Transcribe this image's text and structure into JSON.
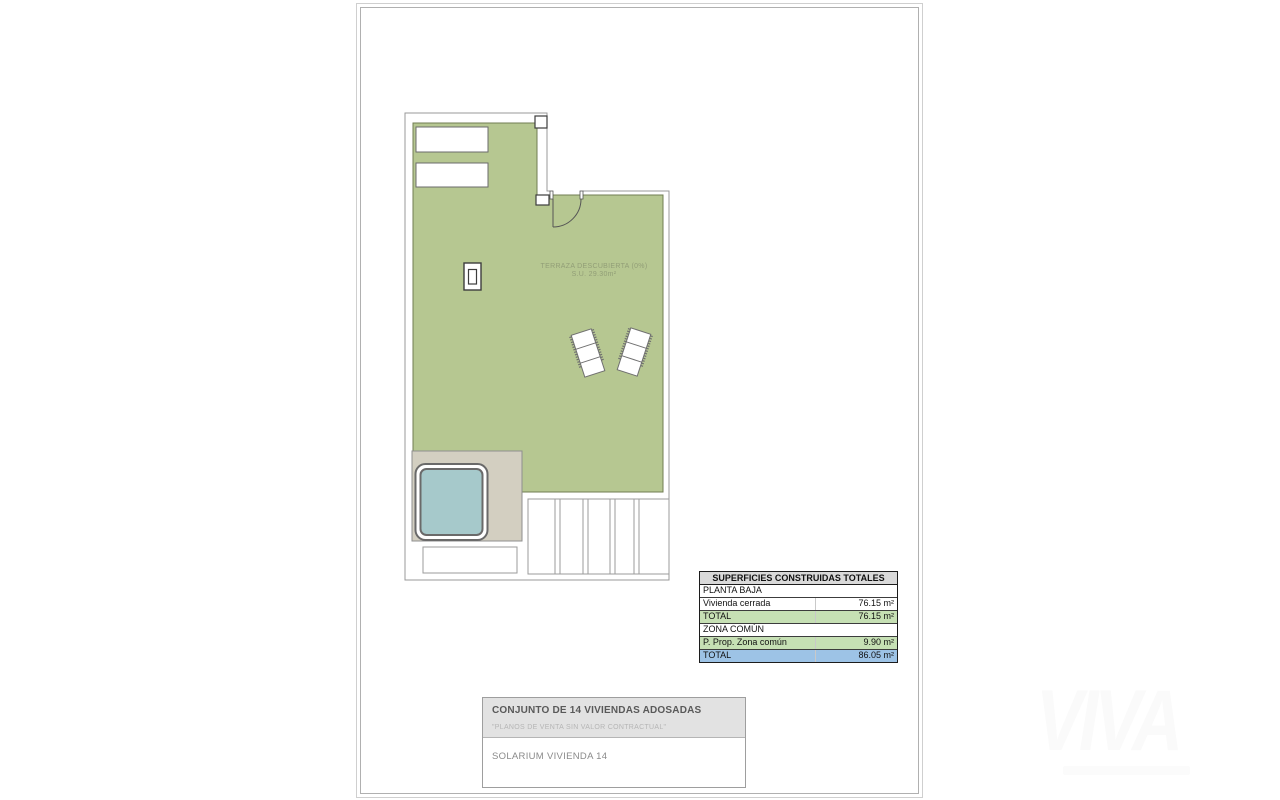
{
  "plan": {
    "room_label_line1": "TERRAZA DESCUBIERTA (0%)",
    "room_label_line2": "S.U. 29.30m²",
    "colors": {
      "terrace_green": "#b6c791",
      "platform_gray": "#d3cfc1",
      "pool_blue": "#a6c9cb",
      "boundary_line": "#999999",
      "wall_line": "#3d3d3d"
    }
  },
  "areas_table": {
    "header": "SUPERFICIES CONSTRUIDAS TOTALES",
    "rows": [
      {
        "label": "PLANTA BAJA",
        "value": ""
      },
      {
        "label": "Vivienda cerrada",
        "value": "76.15 m²"
      },
      {
        "label": "TOTAL",
        "value": "76.15 m²"
      },
      {
        "label": "ZONA COMÚN",
        "value": ""
      },
      {
        "label": "P. Prop. Zona común",
        "value": "9.90 m²"
      },
      {
        "label": "TOTAL",
        "value": "86.05 m²"
      }
    ],
    "colors": {
      "header_bg": "#d9d9d9",
      "subtotal_green": "#c6e0b4",
      "total_blue": "#9dc3e6"
    }
  },
  "title_block": {
    "project_title": "CONJUNTO DE 14 VIVIENDAS ADOSADAS",
    "disclaimer": "\"PLANOS DE VENTA SIN VALOR CONTRACTUAL\"",
    "drawing_title": "SOLARIUM VIVIENDA 14"
  },
  "watermark": {
    "text": "VIVA"
  }
}
